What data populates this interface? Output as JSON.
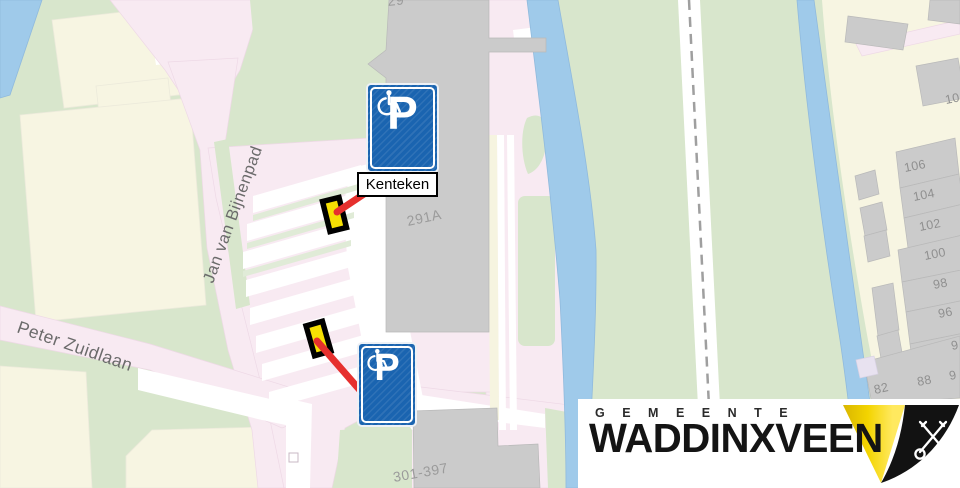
{
  "map": {
    "street_labels": [
      {
        "text": "Jan van Bijnenpad"
      },
      {
        "text": "Peter Zuidlaan"
      }
    ],
    "building_labels": [
      {
        "text": "291A"
      },
      {
        "text": "301-397"
      },
      {
        "text": "29"
      }
    ],
    "house_numbers": [
      {
        "text": "106"
      },
      {
        "text": "104"
      },
      {
        "text": "102"
      },
      {
        "text": "100"
      },
      {
        "text": "98"
      },
      {
        "text": "96"
      },
      {
        "text": "10"
      },
      {
        "text": "9"
      },
      {
        "text": "88"
      },
      {
        "text": "82"
      },
      {
        "text": "9"
      }
    ]
  },
  "annotations": {
    "kenteken_label": "Kenteken",
    "sign_letter": "P"
  },
  "logo": {
    "line1": "GEMEENTE",
    "line2": "WADDINXVEEN"
  },
  "colors": {
    "water_blue": "#9fcaea",
    "grass_green": "#d8e6cc",
    "block_cream": "#f7f5e2",
    "road_pink": "#f8eaf2",
    "building_gray": "#cbcbcb",
    "sign_blue": "#1a64b0",
    "marker_yellow": "#f6e003",
    "highlight_red": "#e6302e",
    "logo_yellow": "#f5d500"
  }
}
